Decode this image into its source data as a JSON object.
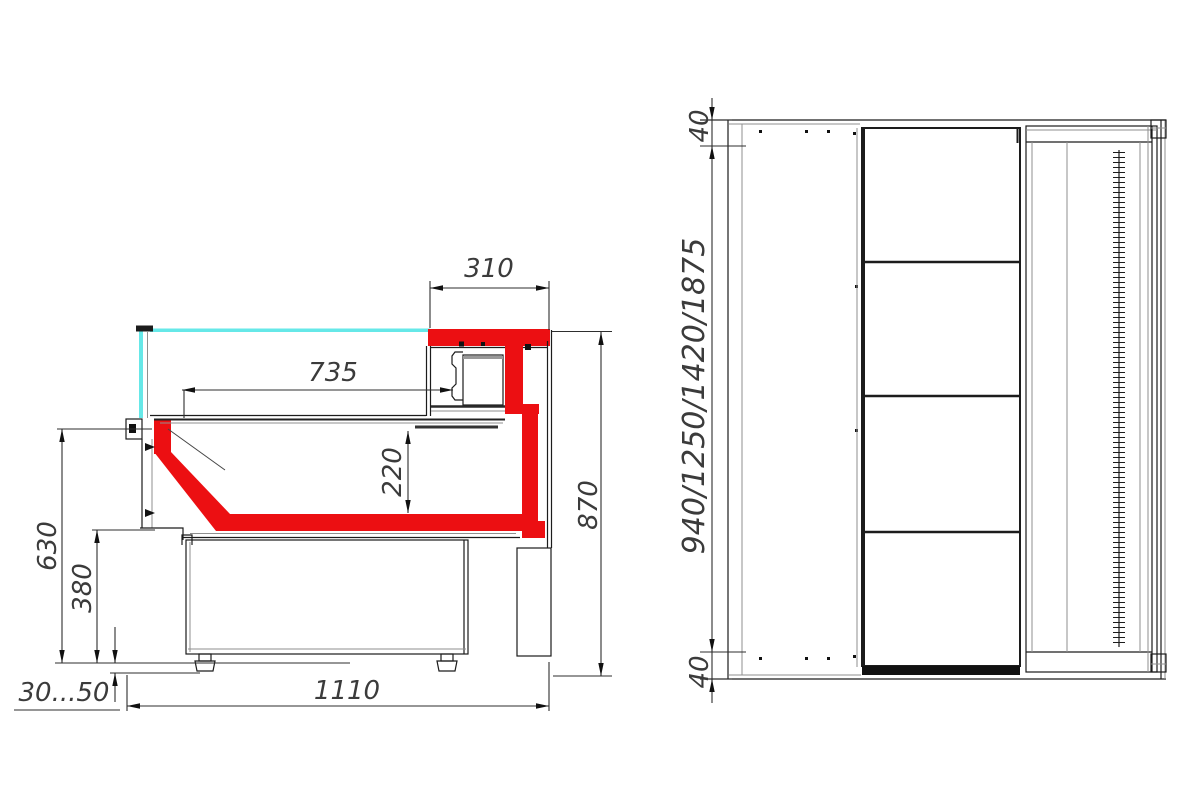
{
  "side_view": {
    "top_overhang": "310",
    "shelf_depth": "735",
    "well_height": "220",
    "total_height": "870",
    "front_height": "630",
    "lower_front_height": "380",
    "leg_adjust_range": "30...50",
    "base_depth": "1110"
  },
  "top_view": {
    "end_frame_top": "40",
    "length_options": "940/1250/1420/1875",
    "end_frame_bottom": "40"
  },
  "colors": {
    "accent_red": "#ec0f12",
    "glass_cyan": "#66e8e8",
    "line_dark": "#1c1c1c",
    "dim_text": "#3b3b3b"
  }
}
